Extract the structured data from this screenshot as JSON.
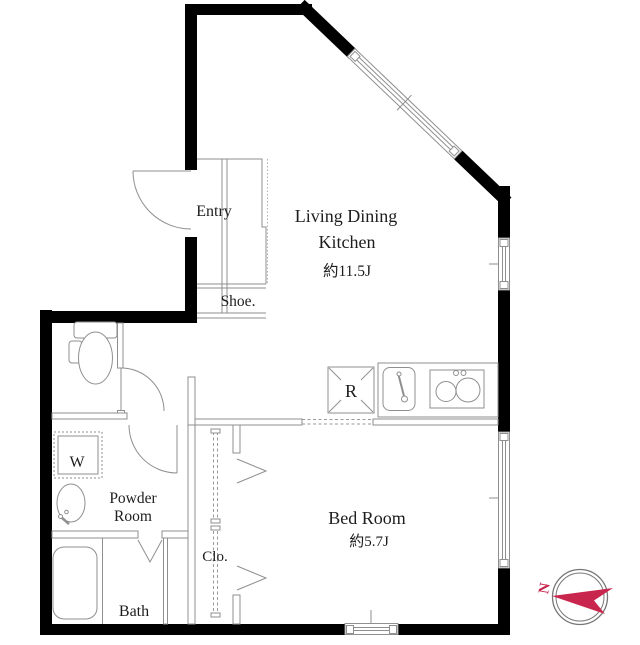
{
  "page": {
    "background": "#ffffff",
    "type": "apartment-floor-plan"
  },
  "colors": {
    "wall": "#000000",
    "thin_line": "#8f8f8f",
    "text": "#1d1d1d",
    "compass_red": "#c9264e"
  },
  "labels": {
    "entry": "Entry",
    "shoe": "Shoe.",
    "ldk_line1": "Living Dining",
    "ldk_line2": "Kitchen",
    "ldk_size": "約11.5J",
    "fridge": "R",
    "bedroom": "Bed Room",
    "bedroom_size": "約5.7J",
    "powder_line1": "Powder",
    "powder_line2": "Room",
    "washer": "W",
    "closet": "Clo.",
    "bath": "Bath",
    "compass_north": "N"
  }
}
